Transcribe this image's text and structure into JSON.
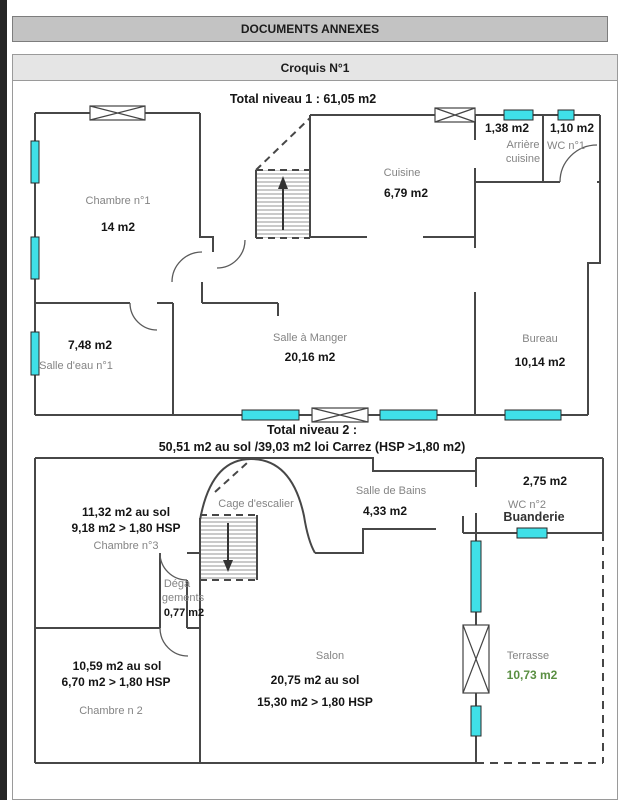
{
  "page": {
    "header": "DOCUMENTS ANNEXES",
    "croquis_title": "Croquis N°1"
  },
  "level1": {
    "title": "Total niveau 1 : 61,05 m2",
    "rooms": {
      "chambre1": {
        "name": "Chambre n°1",
        "area": "14 m2"
      },
      "cuisine": {
        "name": "Cuisine",
        "area": "6,79 m2"
      },
      "arriere_cuisine": {
        "name": "Arrière cuisine",
        "area": "1,38 m2"
      },
      "wc1": {
        "name": "WC n°1",
        "area": "1,10 m2"
      },
      "salle_eau": {
        "name": "Salle d'eau n°1",
        "area": "7,48 m2"
      },
      "salle_a_manger": {
        "name": "Salle à Manger",
        "area": "20,16 m2"
      },
      "bureau": {
        "name": "Bureau",
        "area": "10,14 m2"
      }
    }
  },
  "level2": {
    "title_line1": "Total niveau 2 :",
    "title_line2": "50,51 m2 au sol /39,03 m2 loi Carrez (HSP >1,80 m2)",
    "rooms": {
      "chambre3": {
        "name": "Chambre n°3",
        "area_sol": "11,32 m2 au sol",
        "area_hsp": "9,18 m2 > 1,80 HSP"
      },
      "cage_escalier": {
        "name": "Cage d'escalier"
      },
      "salle_bains": {
        "name": "Salle de Bains",
        "area": "4,33 m2"
      },
      "wc2": {
        "name": "WC n°2",
        "area": "2,75 m2"
      },
      "buanderie": {
        "name": "Buanderie"
      },
      "degagements": {
        "name": "Dégagements",
        "name_lines": [
          "Déga",
          "gements"
        ],
        "area": "0,77 m2"
      },
      "chambre2": {
        "name": "Chambre n 2",
        "area_sol": "10,59 m2 au sol",
        "area_hsp": "6,70 m2 > 1,80 HSP"
      },
      "salon": {
        "name": "Salon",
        "area_sol": "20,75 m2 au sol",
        "area_hsp": "15,30 m2 > 1,80 HSP"
      },
      "terrasse": {
        "name": "Terrasse",
        "area": "10,73 m2"
      }
    }
  },
  "colors": {
    "window": "#3fe0e8",
    "terrace_area_text": "#5a8f42",
    "wall": "#474747",
    "header_bar_bg": "#c3c3c3",
    "croquis_bar_bg": "#e5e5e5"
  }
}
